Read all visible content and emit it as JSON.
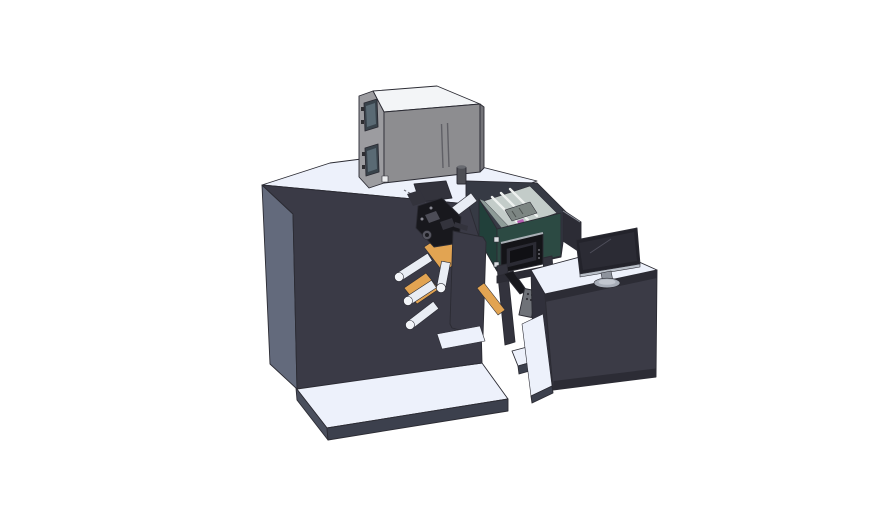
{
  "meta": {
    "canvas_width": 888,
    "canvas_height": 522
  },
  "colors": {
    "background": "#ffffff",
    "outline": "#2b2b33",
    "machine_front": "#3a3a46",
    "machine_side": "#636a7c",
    "surface_white": "#edf1fb",
    "platform_side": "#4a4f5d",
    "platform_front": "#3c404d",
    "cabinet_front": "#8d8d90",
    "cabinet_side": "#9c9ca0",
    "cabinet_top": "#f3f5f7",
    "window_frame": "#39434b",
    "window_glass": "#5a6a74",
    "shell_gray": "#363a44",
    "teal_front": "#2c4a43",
    "teal_side": "#21403a",
    "interior_light": "#c3ccc9",
    "interior_wall": "#8e9c98",
    "magenta_item": "#b75fb3",
    "orange_web": "#e2a452",
    "roller_white": "#e9edf4",
    "mech_black": "#18181d",
    "panel_black": "#141418",
    "screen_dark": "#2b2b34",
    "desk_front": "#3b3b46",
    "desk_side": "#30303b",
    "monitor_screen": "#23232b",
    "monitor_trim": "#b9bfc8",
    "stand_gray": "#a7adb8",
    "pendant_gray": "#6f7278",
    "legs_dark": "#33333d"
  }
}
